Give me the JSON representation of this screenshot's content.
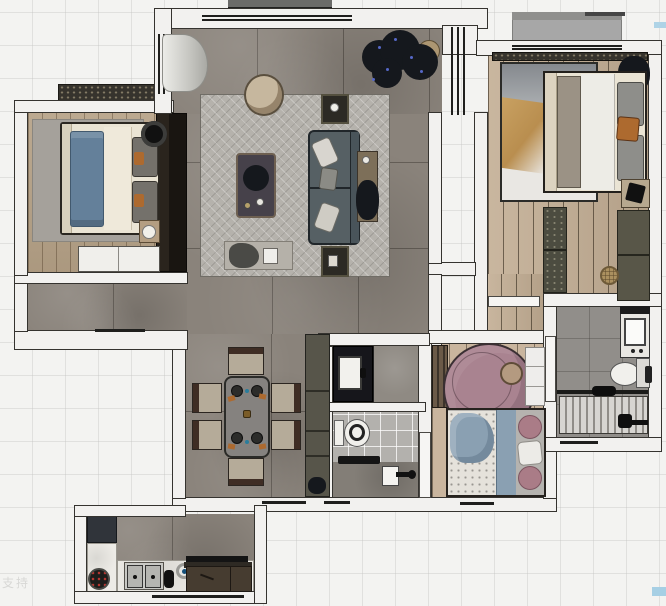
{
  "watermark": {
    "text": "支持"
  },
  "artifacts": {
    "sliver_top_right_color": "#aed3e6",
    "sliver_bottom_right_color": "#a6cfe4"
  },
  "palette": {
    "bg": "#f3f3f1",
    "wall": "#f2f1ef",
    "wall_edge": "#35332f",
    "win": "#1f1f1d",
    "living_floor": "#8a837b",
    "wood_left": "#b6a287",
    "wood_master": "#c3ae94",
    "wood_kid": "#c9b59e",
    "rug_living": "#b5b2ac",
    "rug_bedroom": "#a5a19b",
    "sofa": "#566064",
    "sofa_edge": "#20262a",
    "coffee_table": "#46414a",
    "wood_trim": "#6e6051",
    "dining_chair": "#b5ab99",
    "chair_back": "#3f2d24",
    "dining_table": "#85827f",
    "sideboard": "#57554a",
    "bed_cream": "#eae4d4",
    "throw_blue": "#64809a",
    "bed_blue": "#8aa0b2",
    "pillow_grey": "#74716b",
    "accent_orange": "#ad6a2f",
    "kid_rug": "#a98390",
    "pink_pillow": "#aa7c87",
    "bath_tile": "#b3b1ad",
    "bath_grey": "#918e8a",
    "slat_light": "#d7d5d1",
    "slat_dark": "#908d88",
    "kitchen_counter": "#edebe6",
    "cabinet_brown": "#463c30",
    "fridge": "#30343a",
    "plant_dark": "#15181d",
    "plant_blue": "#5668c8",
    "balcony_slab": "#a7a7a7",
    "watermark": "#c9c9c7"
  }
}
